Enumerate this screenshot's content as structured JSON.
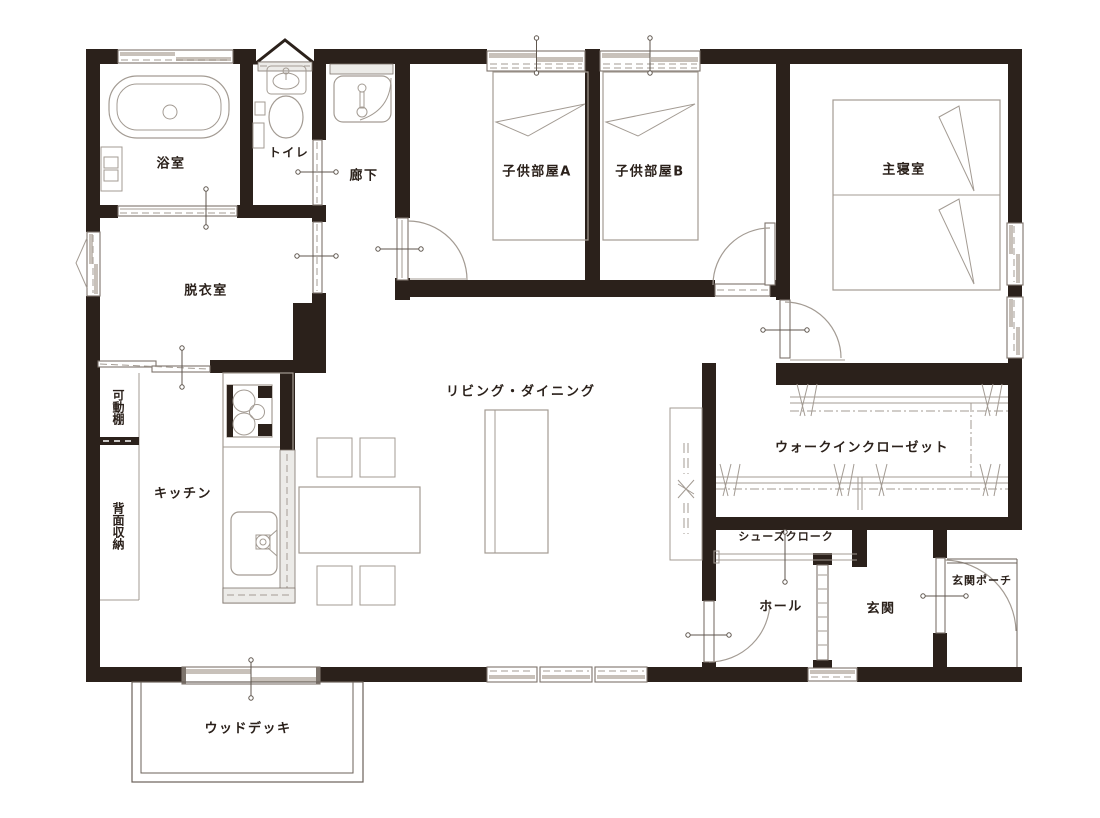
{
  "plan_title": "1LDK house floor plan",
  "colors": {
    "wall": "#2b211b",
    "line": "#a39b93",
    "frame": "#7d746c",
    "sash": "#c8c1ba",
    "marker": "#5f564e",
    "text": "#2b211b"
  },
  "rooms": {
    "bath": {
      "label": "浴室"
    },
    "toilet": {
      "label": "トイレ"
    },
    "hallway": {
      "label": "廊下"
    },
    "kids_a": {
      "label": "子供部屋A"
    },
    "kids_b": {
      "label": "子供部屋B"
    },
    "master": {
      "label": "主寝室"
    },
    "washroom": {
      "label": "脱衣室"
    },
    "living": {
      "label": "リビング・ダイニング"
    },
    "kitchen": {
      "label": "キッチン"
    },
    "movable_shelf": {
      "label": "可動棚"
    },
    "back_storage": {
      "label": "背面収納"
    },
    "wic": {
      "label": "ウォークインクローゼット"
    },
    "shoe_cloak": {
      "label": "シューズクローク"
    },
    "hall": {
      "label": "ホール"
    },
    "entrance": {
      "label": "玄関"
    },
    "porch": {
      "label": "玄関ポーチ"
    },
    "wood_deck": {
      "label": "ウッドデッキ"
    }
  }
}
